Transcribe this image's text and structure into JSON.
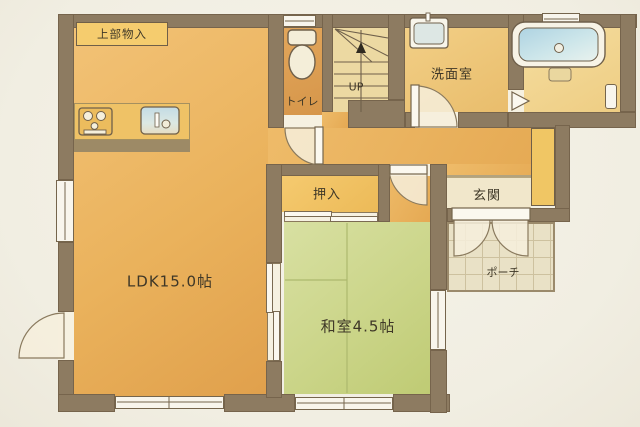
{
  "plan_title": "1F floor plan",
  "rooms": {
    "ldk": {
      "label": "LDK15.0帖"
    },
    "washitsu": {
      "label": "和室4.5帖"
    },
    "toilet": {
      "label": "トイレ"
    },
    "washroom": {
      "label": "洗面室"
    },
    "closet": {
      "label": "押入"
    },
    "genkan": {
      "label": "玄関"
    },
    "porch": {
      "label": "ポーチ"
    },
    "upper_storage": {
      "label": "上部物入"
    },
    "stairs": {
      "label": "UP"
    }
  },
  "colors": {
    "paper": "#f3f0e6",
    "wall": "#8d7b61",
    "ldk_floor": "#eab25c",
    "hall_floor": "#eebb69",
    "tatami": "#cbd589",
    "closet_floor": "#f2c468",
    "stairs_floor": "#ecd9a2",
    "washroom_floor": "#eec87e",
    "bathroom_floor": "#f3da9a",
    "genkan_tataki": "#f1e7cb",
    "porch_floor": "#e9e1c6",
    "bath_water": "#aed3e2",
    "sink_water": "#c3dbe4",
    "window": "#f8f5ec",
    "text": "#3e3727"
  }
}
